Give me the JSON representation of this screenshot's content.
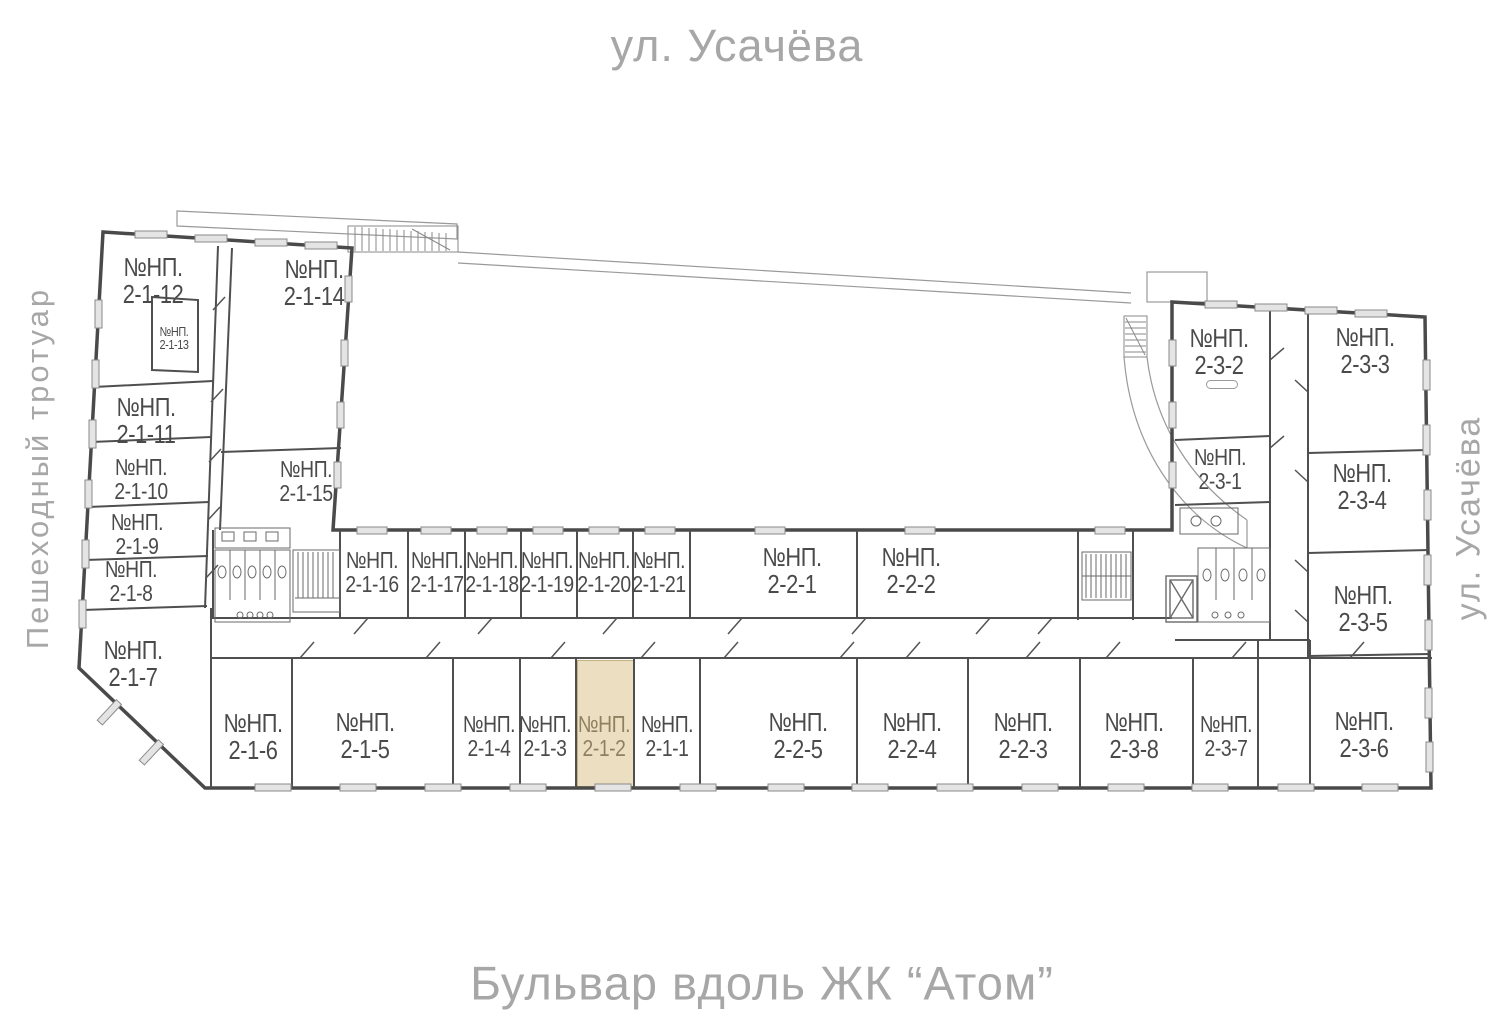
{
  "streets": {
    "top": "ул. Усачёва",
    "bottom": "Бульвар вдоль ЖК “Атом”",
    "left": "Пешеходный тротуар",
    "right": "ул. Усачёва"
  },
  "labels": {
    "np_prefix": "№НП."
  },
  "highlighted_unit": "2-1-2",
  "colors": {
    "highlight_fill": "#ecdfc1",
    "highlight_border": "#c5b284",
    "highlight_text": "#8f8060",
    "wall": "#4a4a4a",
    "thin_line": "#9a9a9a",
    "window_fill": "#e4e4e4",
    "street_text": "#a7a7a7",
    "unit_text": "#4a4a4a"
  },
  "units": [
    {
      "id": "2-1-12"
    },
    {
      "id": "2-1-13"
    },
    {
      "id": "2-1-14"
    },
    {
      "id": "2-1-11"
    },
    {
      "id": "2-1-10"
    },
    {
      "id": "2-1-9"
    },
    {
      "id": "2-1-8"
    },
    {
      "id": "2-1-15"
    },
    {
      "id": "2-1-7"
    },
    {
      "id": "2-1-6"
    },
    {
      "id": "2-1-16"
    },
    {
      "id": "2-1-17"
    },
    {
      "id": "2-1-18"
    },
    {
      "id": "2-1-19"
    },
    {
      "id": "2-1-20"
    },
    {
      "id": "2-1-21"
    },
    {
      "id": "2-2-1"
    },
    {
      "id": "2-2-2"
    },
    {
      "id": "2-1-5"
    },
    {
      "id": "2-1-4"
    },
    {
      "id": "2-1-3"
    },
    {
      "id": "2-1-2",
      "highlighted": true
    },
    {
      "id": "2-1-1"
    },
    {
      "id": "2-2-5"
    },
    {
      "id": "2-2-4"
    },
    {
      "id": "2-2-3"
    },
    {
      "id": "2-3-8"
    },
    {
      "id": "2-3-7"
    },
    {
      "id": "2-3-6"
    },
    {
      "id": "2-3-2"
    },
    {
      "id": "2-3-3"
    },
    {
      "id": "2-3-1"
    },
    {
      "id": "2-3-4"
    },
    {
      "id": "2-3-5"
    }
  ]
}
